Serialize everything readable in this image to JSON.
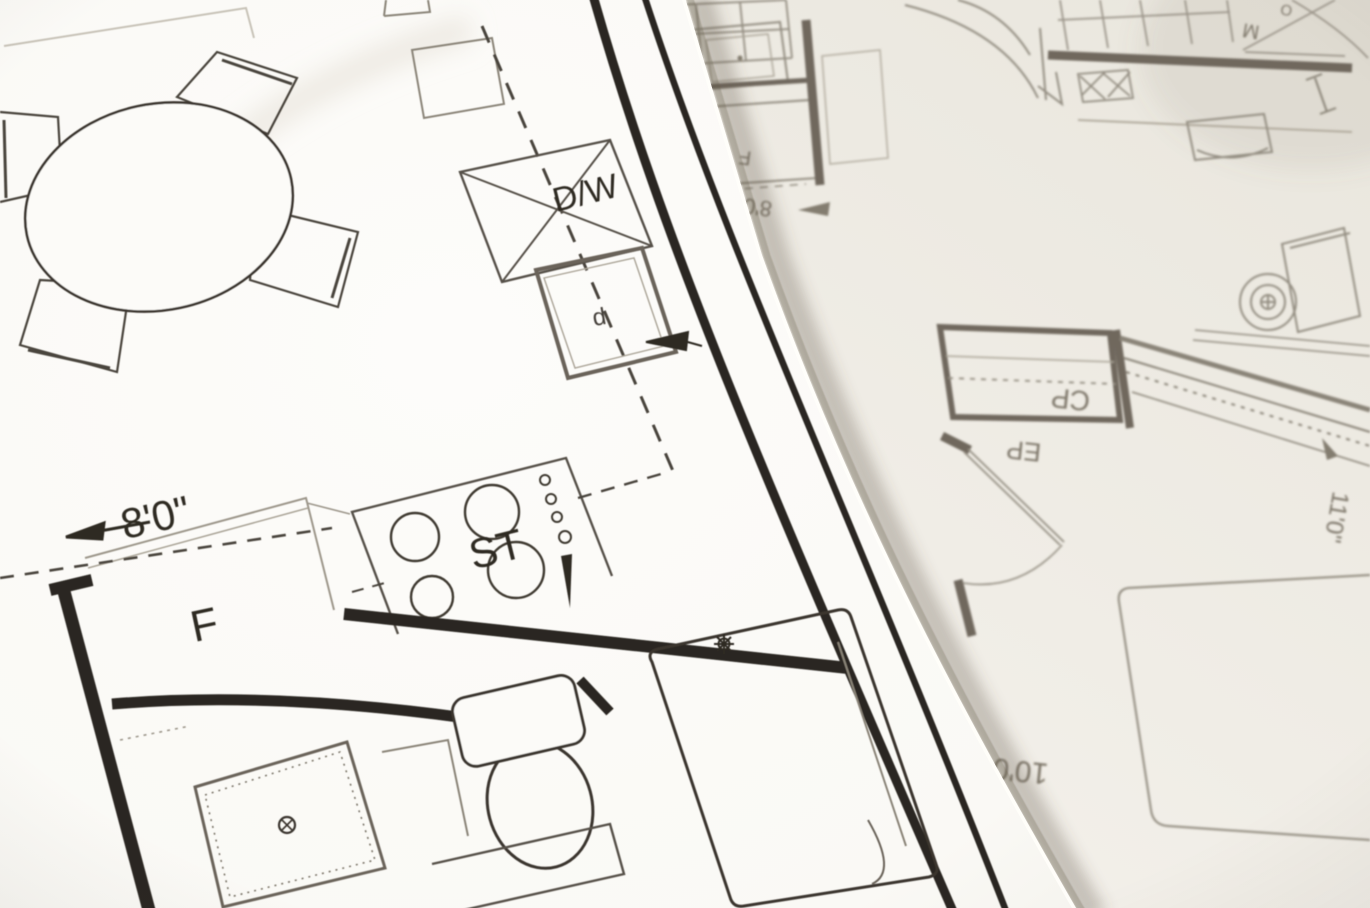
{
  "scene": {
    "description": "Photograph of two overlapping architectural floor-plan sheets; top sheet shows a kitchen and bathroom plan in sharp focus, under sheet is rotated upside down and out of focus"
  },
  "top_sheet": {
    "labels": {
      "dishwasher": "D/W",
      "stove": "ST",
      "refrigerator": "F",
      "cabinet_letter": "d",
      "width_dimension": "8'0\""
    }
  },
  "under_sheet": {
    "labels": {
      "closet_cp": "CP",
      "entry_ep": "EP",
      "fixture_letter": "F",
      "letter_m": "M",
      "letter_o": "O",
      "dim_eight": "8'0\"",
      "dim_eleven": "11'0\"",
      "dim_ten": "10'0\""
    }
  },
  "colors": {
    "paper_top": "#fcfbf8",
    "paper_under": "#f1eee7",
    "ink": "#2b2620",
    "mid_line": "#57514a",
    "light_line": "#9d978b",
    "under_line": "#8f897d",
    "under_wall": "#6f685d",
    "edge_shadow": "rgba(95,85,68,0.30)"
  }
}
